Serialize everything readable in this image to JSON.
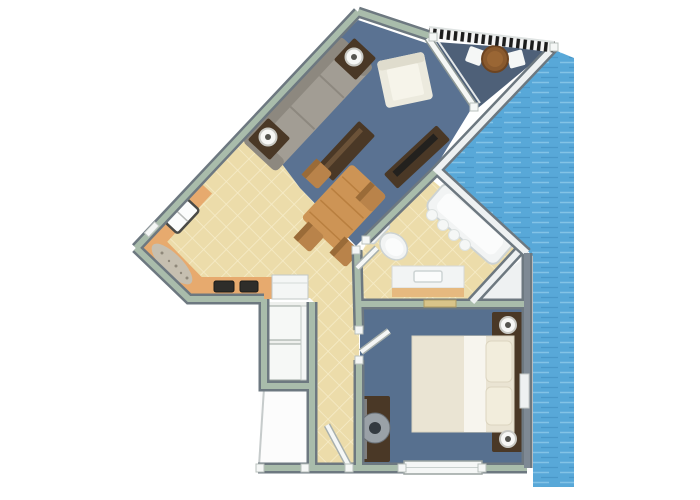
{
  "scene": {
    "type": "3d-floor-plan",
    "description": "Isometric 3D floor plan of a one-bedroom waterfront apartment with balcony",
    "background": "#ffffff"
  },
  "colors": {
    "water": "#58a8d8",
    "water_ripple_light": "#83c3e6",
    "water_ripple_dark": "#4a97c8",
    "wall_top": "#a9bcab",
    "wall_edge": "#6d7880",
    "wall_white_face": "#eef1f2",
    "wall_gray_blue": "#7e8994",
    "carpet_living": "#5a7292",
    "carpet_bedroom": "#57708f",
    "balcony_floor": "#4e6078",
    "tile": "#ecdcaa",
    "tile_line": "#f6ecc8",
    "counter": "#e7aa6e",
    "granite": "#c6bfb0",
    "wood_dark": "#4a3826",
    "wood_table": "#cd9455",
    "wood_chair": "#b9834a",
    "sofa": "#a29d94",
    "sofa_back": "#8d887f",
    "armchair": "#eceade",
    "armchair_seat": "#f6f4ea",
    "bed_blanket": "#eae4d3",
    "bed_sheet": "#f7f5ee",
    "pillow": "#f2eddc",
    "fixture_white": "#f2f4f4",
    "fixture_inner": "#fbfcfc",
    "fixture_rim": "#cdd3d3",
    "vanity_front": "#e6b97f",
    "appliance_white": "#f4f6f5",
    "burner_dark": "#2e2d2a",
    "door_white": "#f5f7f6",
    "door_shadow": "#a8b0ad",
    "railing_light": "#f4f4f4",
    "railing_dark": "#1c1c1c",
    "lamp_white": "#f7f7f5",
    "lamp_ring": "#c9c9c4",
    "lamp_center": "#55544f",
    "art_mural": "#3f607b",
    "art_streak": "#6f93ad",
    "mirror_glass": "#9aa1a7",
    "mirror_center": "#343a40",
    "plaque_tan": "#d9c489",
    "porch_white": "#fcfcfc",
    "shelf_white": "#f6f8f6",
    "tv_screen": "#23211e",
    "balcony_table": "#8a5a2e"
  },
  "rooms": [
    {
      "name": "living-room",
      "floor": "blue-gray carpet"
    },
    {
      "name": "dining-area",
      "floor": "carpet and tan tile"
    },
    {
      "name": "kitchen",
      "floor": "tan tile"
    },
    {
      "name": "balcony",
      "floor": "dark slate deck"
    },
    {
      "name": "bathroom",
      "floor": "tan tile"
    },
    {
      "name": "bedroom",
      "floor": "blue-gray carpet"
    },
    {
      "name": "hallway",
      "floor": "tan tile"
    },
    {
      "name": "closet",
      "floor": "white shelving nook"
    },
    {
      "name": "entry-porch",
      "floor": "white"
    },
    {
      "name": "waterfront",
      "floor": "rippled water"
    }
  ],
  "furniture": {
    "living_room": [
      "three-seat-sofa",
      "coffee-table",
      "side-table-with-lamp-left",
      "side-table-with-lamp-right",
      "white-armchair",
      "tv-console-with-tv",
      "wall-art-mural",
      "dining-table",
      "four-dining-chairs"
    ],
    "balcony": [
      "round-cafe-table",
      "two-white-chairs",
      "striped-railing",
      "sliding-glass-door"
    ],
    "kitchen": [
      "l-shaped-counter",
      "sink",
      "two-burner-cooktop",
      "white-appliance",
      "granite-section"
    ],
    "bathroom": [
      "bathtub-with-curtain",
      "toilet",
      "vanity-with-sink",
      "door"
    ],
    "bedroom": [
      "double-bed",
      "two-pillows",
      "headboard-shelf",
      "two-nightstands-with-lamps",
      "dresser-with-round-mirror",
      "window",
      "door"
    ],
    "hallway": [
      "closet-shelves",
      "entry-door"
    ]
  }
}
